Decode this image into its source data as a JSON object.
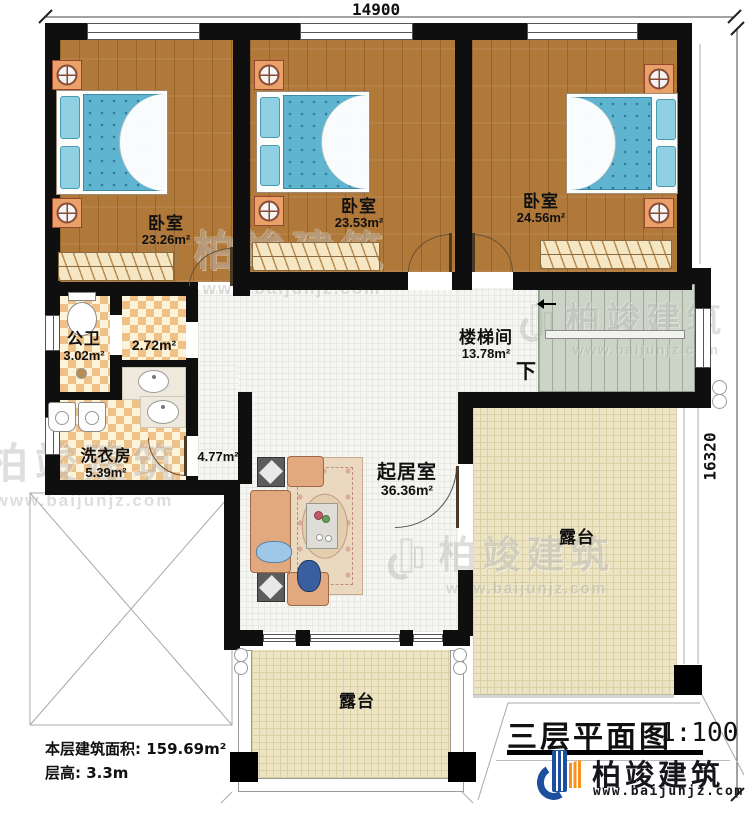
{
  "dimensions": {
    "top": "14900",
    "right": "16320"
  },
  "rooms": {
    "bedroom1": {
      "name": "卧室",
      "area": "23.26m²"
    },
    "bedroom2": {
      "name": "卧室",
      "area": "23.53m²"
    },
    "bedroom3": {
      "name": "卧室",
      "area": "24.56m²"
    },
    "bathroom": {
      "name": "公卫",
      "area": "3.02m²"
    },
    "closet": {
      "area": "2.72m²"
    },
    "laundry": {
      "name": "洗衣房",
      "area": "5.39m²"
    },
    "corridor": {
      "area": "4.77m²"
    },
    "stairwell": {
      "name": "楼梯间",
      "area": "13.78m²",
      "down": "下"
    },
    "living": {
      "name": "起居室",
      "area": "36.36m²"
    },
    "terrace_right": {
      "name": "露台"
    },
    "terrace_bottom": {
      "name": "露台"
    }
  },
  "info": {
    "area_label": "本层建筑面积:",
    "area_value": "159.69m²",
    "height_label": "层高:",
    "height_value": "3.3m"
  },
  "titleblock": {
    "title": "三层平面图",
    "scale": "1:100"
  },
  "brand": {
    "name": "柏竣建筑",
    "website": "www.baijunjz.com"
  },
  "watermark": {
    "text": "柏竣建筑",
    "url": "www.baijunjz.com"
  },
  "colors": {
    "wall": "#0f0f0f",
    "wood": "#b0793a",
    "bed": "#5fb4cf",
    "tileA": "#eec189",
    "tileB": "#fdf3d9",
    "terrace": "#ece4c3",
    "stairs": "#cbd4c6",
    "brandBlue": "#1d4f9f",
    "accentOrange": "#f6921e"
  }
}
